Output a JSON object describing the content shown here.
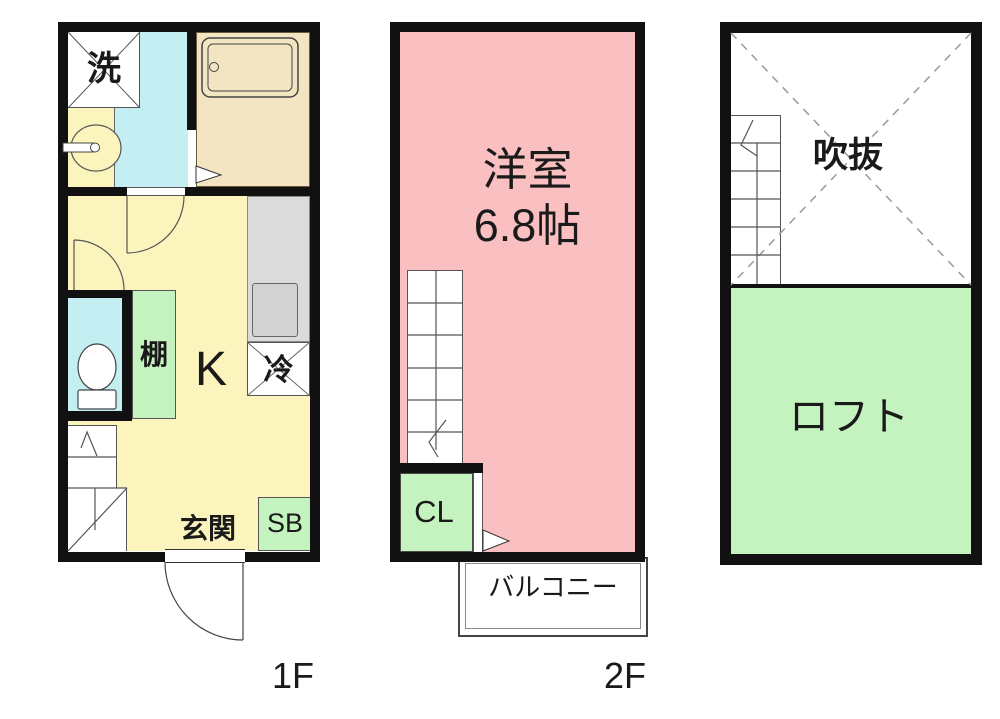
{
  "floor1": {
    "label": "1F",
    "rooms": {
      "washer": "洗",
      "shelf": "棚",
      "kitchen": "K",
      "fridge": "冷",
      "entrance": "玄関",
      "shoebox": "SB"
    }
  },
  "floor2": {
    "label": "2F",
    "rooms": {
      "western_room": "洋室",
      "western_room_size": "6.8帖",
      "closet": "CL",
      "balcony": "バルコニー"
    }
  },
  "loft": {
    "rooms": {
      "void": "吹抜",
      "loft": "ロフト"
    }
  },
  "colors": {
    "wall": "#111111",
    "kitchen_yellow": "#FBF5BD",
    "sanitary_cyan": "#C3EFF3",
    "room_pink": "#FABFC0",
    "storage_green": "#C5F3BF",
    "bath_tan": "#F4E5C2",
    "counter_gray": "#DBDBDB"
  }
}
